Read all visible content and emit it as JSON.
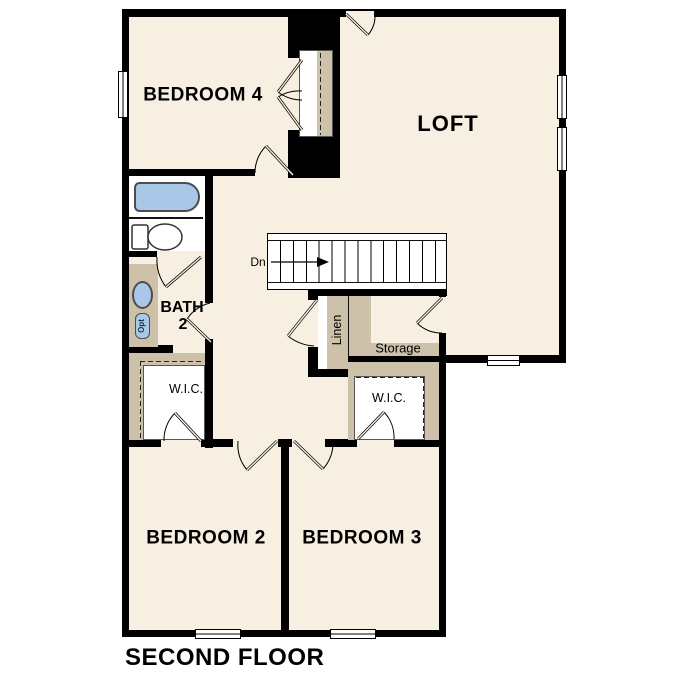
{
  "title": "SECOND FLOOR",
  "labels": {
    "bedroom4": "BEDROOM 4",
    "loft": "LOFT",
    "bedroom2": "BEDROOM 2",
    "bedroom3": "BEDROOM 3",
    "bath_line1": "BATH",
    "bath_line2": "2",
    "wic_left": "W.I.C.",
    "wic_right": "W.I.C.",
    "storage": "Storage",
    "linen": "Linen",
    "stairs_direction": "Dn",
    "vanity_optional": "Opt"
  },
  "colors": {
    "floor": "#f6efe2",
    "wall": "#000000",
    "closet_tan": "#cdc1a9",
    "fixture_blue": "#a9c8e8",
    "outside": "#ffffff"
  }
}
